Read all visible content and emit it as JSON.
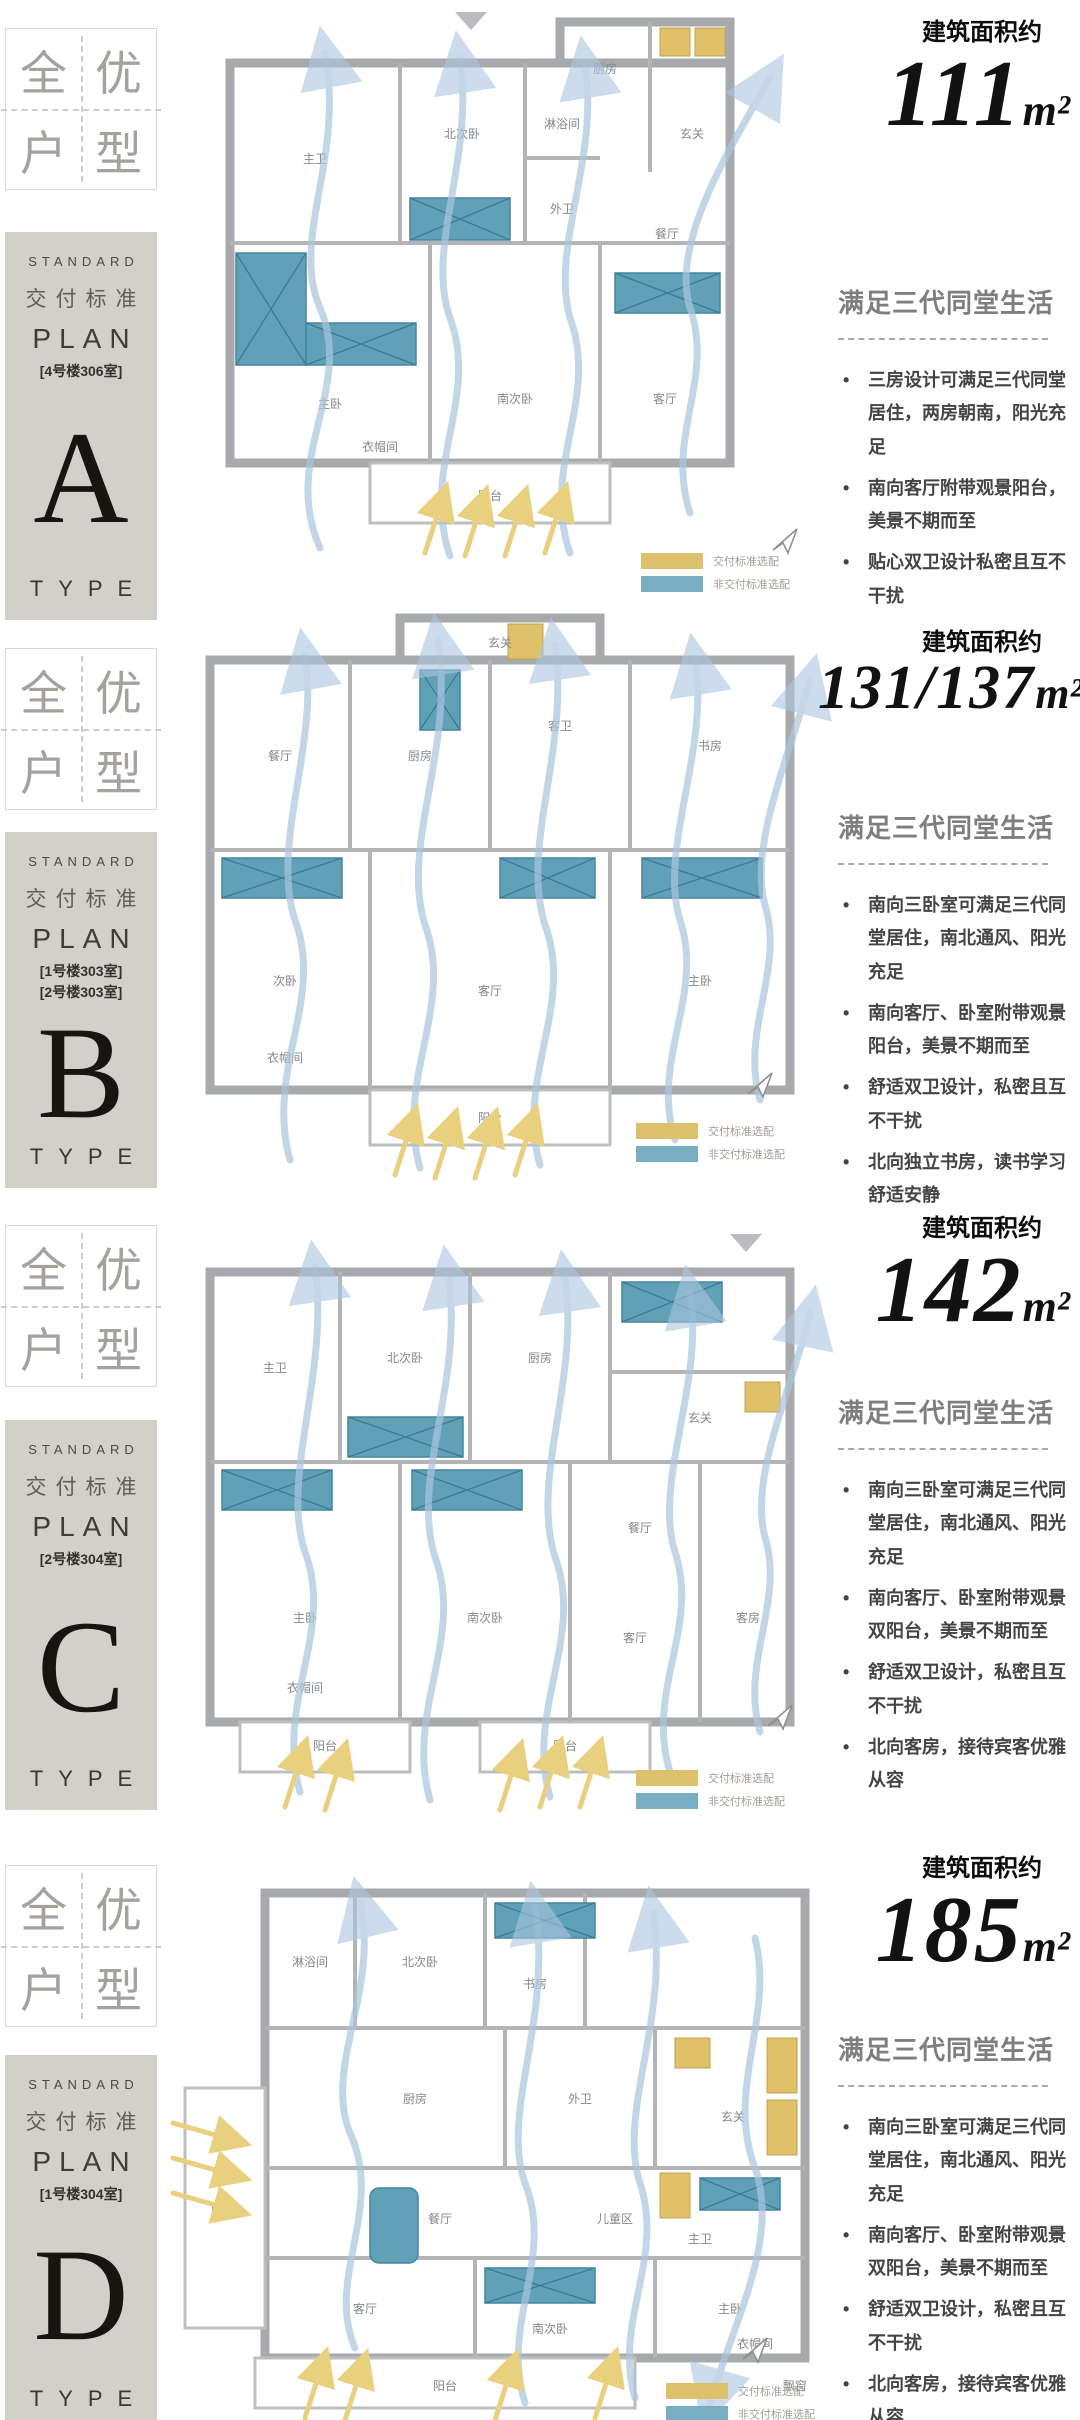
{
  "palette": {
    "plate_bg": "#d3d0ca",
    "standard_swatch": "#ddc06c",
    "non_standard_swatch": "#79aec2",
    "flow_arrow": "#abc6df",
    "sun_arrow": "#e8d07e"
  },
  "legend": {
    "standard_label": "交付标准选配",
    "non_standard_label": "非交付标准选配"
  },
  "sections": [
    {
      "badge": {
        "c1": "全",
        "c2": "优",
        "c3": "户",
        "c4": "型"
      },
      "plate": {
        "standard": "STANDARD",
        "delivery": "交付标准",
        "plan": "PLAN",
        "units": [
          "[4号楼306室]"
        ],
        "letter": "A",
        "type": "TYPE"
      },
      "area": {
        "label": "建筑面积约",
        "value": "111",
        "unit": "m²"
      },
      "feature": {
        "title": "满足三代同堂生活",
        "bullets": [
          "三房设计可满足三代同堂居住，两房朝南，阳光充足",
          "南向客厅附带观景阳台，美景不期而至",
          "贴心双卫设计私密且互不干扰"
        ]
      },
      "rooms": [
        "主卫",
        "北次卧",
        "淋浴间",
        "外卫",
        "厨房",
        "玄关",
        "餐厅",
        "主卧",
        "衣帽间",
        "南次卧",
        "客厅",
        "阳台"
      ]
    },
    {
      "badge": {
        "c1": "全",
        "c2": "优",
        "c3": "户",
        "c4": "型"
      },
      "plate": {
        "standard": "STANDARD",
        "delivery": "交付标准",
        "plan": "PLAN",
        "units": [
          "[1号楼303室]",
          "[2号楼303室]"
        ],
        "letter": "B",
        "type": "TYPE"
      },
      "area": {
        "label": "建筑面积约",
        "value": "131/137",
        "unit": "m²"
      },
      "feature": {
        "title": "满足三代同堂生活",
        "bullets": [
          "南向三卧室可满足三代同堂居住，南北通风、阳光充足",
          "南向客厅、卧室附带观景阳台，美景不期而至",
          "舒适双卫设计，私密且互不干扰",
          "北向独立书房，读书学习舒适安静"
        ]
      },
      "rooms": [
        "餐厅",
        "厨房",
        "客卫",
        "书房",
        "玄关",
        "次卧",
        "客厅",
        "主卧",
        "衣帽间",
        "阳台"
      ]
    },
    {
      "badge": {
        "c1": "全",
        "c2": "优",
        "c3": "户",
        "c4": "型"
      },
      "plate": {
        "standard": "STANDARD",
        "delivery": "交付标准",
        "plan": "PLAN",
        "units": [
          "[2号楼304室]"
        ],
        "letter": "C",
        "type": "TYPE"
      },
      "area": {
        "label": "建筑面积约",
        "value": "142",
        "unit": "m²"
      },
      "feature": {
        "title": "满足三代同堂生活",
        "bullets": [
          "南向三卧室可满足三代同堂居住，南北通风、阳光充足",
          "南向客厅、卧室附带观景双阳台，美景不期而至",
          "舒适双卫设计，私密且互不干扰",
          "北向客房，接待宾客优雅从容"
        ]
      },
      "rooms": [
        "主卫",
        "北次卧",
        "厨房",
        "餐厅",
        "玄关",
        "主卧",
        "南次卧",
        "客厅",
        "客房",
        "衣帽间",
        "阳台"
      ]
    },
    {
      "badge": {
        "c1": "全",
        "c2": "优",
        "c3": "户",
        "c4": "型"
      },
      "plate": {
        "standard": "STANDARD",
        "delivery": "交付标准",
        "plan": "PLAN",
        "units": [
          "[1号楼304室]"
        ],
        "letter": "D",
        "type": "TYPE"
      },
      "area": {
        "label": "建筑面积约",
        "value": "185",
        "unit": "m²"
      },
      "feature": {
        "title": "满足三代同堂生活",
        "bullets": [
          "南向三卧室可满足三代同堂居住，南北通风、阳光充足",
          "南向客厅、卧室附带观景双阳台，美景不期而至",
          "舒适双卫设计，私密且互不干扰",
          "北向客房，接待宾客优雅从容"
        ]
      },
      "rooms": [
        "淋浴间",
        "北次卧",
        "书房",
        "厨房",
        "外卫",
        "玄关",
        "餐厅",
        "儿童区",
        "客厅",
        "南次卧",
        "主卧",
        "主卫",
        "衣帽间",
        "阳台",
        "飘窗"
      ]
    }
  ]
}
